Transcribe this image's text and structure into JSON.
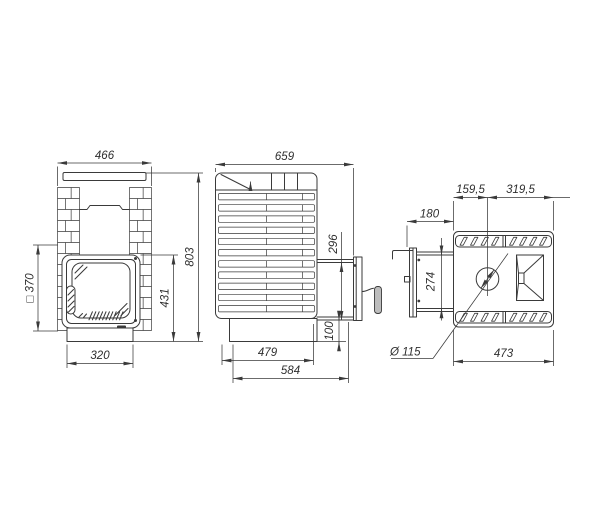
{
  "drawing": {
    "type": "stove-technical-dimension-drawing",
    "colors": {
      "line": "#3a3a3a",
      "background": "#ffffff",
      "handle_grip": "#bdbdbd"
    },
    "views": {
      "front": {
        "name": "front-view",
        "label_top_width": "466",
        "label_total_height": "803",
        "label_door_height": "431",
        "label_base_width": "320",
        "label_opening_square": "□ 370"
      },
      "side": {
        "name": "side-view",
        "label_total_depth": "659",
        "label_door_frame_height": "296",
        "label_door_bottom_offset": "100",
        "label_body_depth": "479",
        "label_depth_with_tunnel": "584"
      },
      "top": {
        "name": "top-view",
        "label_chimney_from_front": "159,5",
        "label_chimney_from_back": "319,5",
        "label_tunnel_length": "180",
        "label_tunnel_width": "274",
        "label_chimney_diameter": "Ø 115",
        "label_body_width": "473"
      }
    }
  }
}
